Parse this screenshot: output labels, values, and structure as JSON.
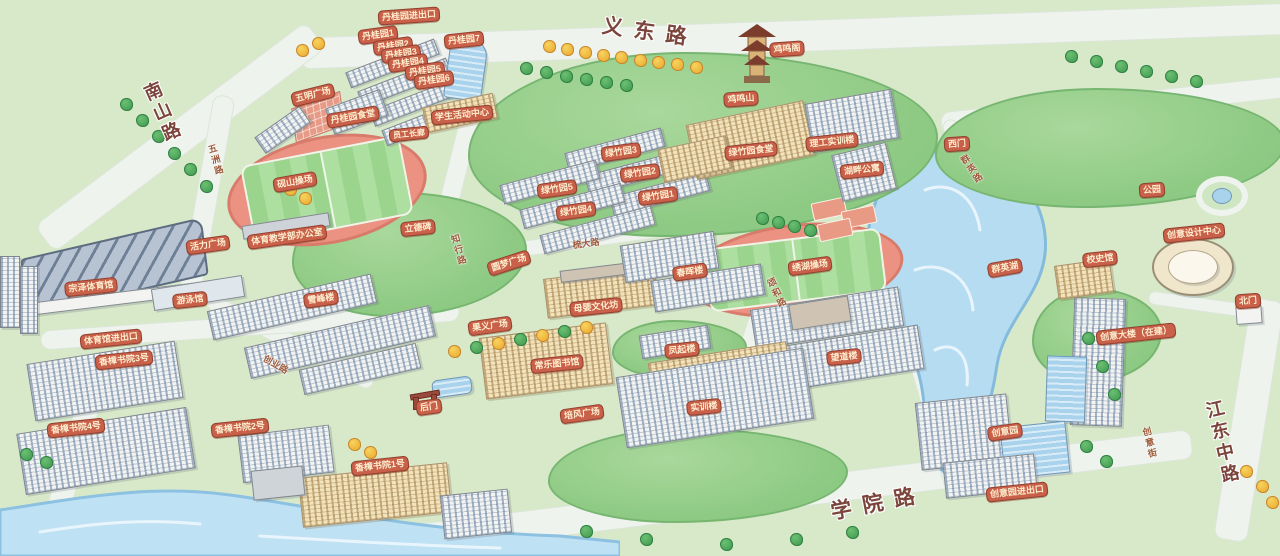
{
  "map": {
    "colors": {
      "ground_green": "#d8e9ca",
      "hill_green": "#8cc982",
      "road_light": "#eef3ee",
      "water_blue": "#b6dcf2",
      "track_salmon": "#ec9283",
      "field_green": "#9bd58d",
      "badge_bg": "#c96049",
      "badge_text": "#fdeecf",
      "major_road_text": "#7b453c"
    },
    "labels": [
      {
        "text": "丹桂园进出口",
        "x": 409,
        "y": 16,
        "rot": -4,
        "kind": "badge",
        "name": "label-gate-dangui"
      },
      {
        "text": "丹桂园1",
        "x": 378,
        "y": 35,
        "rot": -8,
        "kind": "badge",
        "name": "label-dorm-dangui-1"
      },
      {
        "text": "丹桂园2",
        "x": 393,
        "y": 46,
        "rot": -8,
        "kind": "badge",
        "name": "label-dorm-dangui-2"
      },
      {
        "text": "丹桂园3",
        "x": 401,
        "y": 54,
        "rot": -8,
        "kind": "badge",
        "name": "label-dorm-dangui-3"
      },
      {
        "text": "丹桂园4",
        "x": 408,
        "y": 63,
        "rot": -8,
        "kind": "badge",
        "name": "label-dorm-dangui-4"
      },
      {
        "text": "丹桂园5",
        "x": 425,
        "y": 71,
        "rot": -8,
        "kind": "badge",
        "name": "label-dorm-dangui-5"
      },
      {
        "text": "丹桂园6",
        "x": 434,
        "y": 80,
        "rot": -8,
        "kind": "badge",
        "name": "label-dorm-dangui-6"
      },
      {
        "text": "丹桂园7",
        "x": 464,
        "y": 40,
        "rot": -6,
        "kind": "badge",
        "name": "label-dorm-dangui-7"
      },
      {
        "text": "五明广场",
        "x": 313,
        "y": 95,
        "rot": -14,
        "kind": "badge",
        "name": "label-plaza-wuming"
      },
      {
        "text": "丹桂园食堂",
        "x": 353,
        "y": 117,
        "rot": -10,
        "kind": "badge",
        "name": "label-canteen-dangui"
      },
      {
        "text": "学生活动中心",
        "x": 462,
        "y": 115,
        "rot": -6,
        "kind": "badge",
        "name": "label-student-activity-center"
      },
      {
        "text": "员工长廊",
        "x": 409,
        "y": 134,
        "rot": -6,
        "kind": "badge-sm",
        "name": "label-staff-corridor"
      },
      {
        "text": "砚山操场",
        "x": 295,
        "y": 182,
        "rot": -10,
        "kind": "badge",
        "name": "label-stadium-yanshan"
      },
      {
        "text": "体育教学部办公室",
        "x": 287,
        "y": 237,
        "rot": -8,
        "kind": "badge",
        "name": "label-pe-office"
      },
      {
        "text": "立德碑",
        "x": 418,
        "y": 228,
        "rot": -6,
        "kind": "badge",
        "name": "label-monument-lide"
      },
      {
        "text": "活力广场",
        "x": 208,
        "y": 245,
        "rot": -8,
        "kind": "badge",
        "name": "label-plaza-vitality"
      },
      {
        "text": "宗泽体育馆",
        "x": 91,
        "y": 287,
        "rot": -6,
        "kind": "badge",
        "name": "label-gym-zongze"
      },
      {
        "text": "游泳馆",
        "x": 190,
        "y": 300,
        "rot": -6,
        "kind": "badge",
        "name": "label-natatorium"
      },
      {
        "text": "体育馆进出口",
        "x": 111,
        "y": 339,
        "rot": -6,
        "kind": "badge",
        "name": "label-gate-gym"
      },
      {
        "text": "香樟书院3号",
        "x": 124,
        "y": 360,
        "rot": -6,
        "kind": "badge",
        "name": "label-dorm-xiangzhang-3"
      },
      {
        "text": "香樟书院4号",
        "x": 76,
        "y": 428,
        "rot": -6,
        "kind": "badge",
        "name": "label-dorm-xiangzhang-4"
      },
      {
        "text": "香樟书院2号",
        "x": 240,
        "y": 428,
        "rot": -6,
        "kind": "badge",
        "name": "label-dorm-xiangzhang-2"
      },
      {
        "text": "香樟书院1号",
        "x": 380,
        "y": 466,
        "rot": -6,
        "kind": "badge",
        "name": "label-dorm-xiangzhang-1"
      },
      {
        "text": "雪峰楼",
        "x": 321,
        "y": 299,
        "rot": -8,
        "kind": "badge",
        "name": "label-building-xuefeng"
      },
      {
        "text": "后门",
        "x": 429,
        "y": 407,
        "rot": -8,
        "kind": "badge",
        "name": "label-back-gate"
      },
      {
        "text": "果义广场",
        "x": 490,
        "y": 326,
        "rot": -8,
        "kind": "badge",
        "name": "label-plaza-guoyi"
      },
      {
        "text": "常乐图书馆",
        "x": 557,
        "y": 364,
        "rot": -6,
        "kind": "badge",
        "name": "label-library-changle"
      },
      {
        "text": "母婴文化坊",
        "x": 596,
        "y": 307,
        "rot": -6,
        "kind": "badge",
        "name": "label-muying-culture-hall"
      },
      {
        "text": "圆梦广场",
        "x": 509,
        "y": 263,
        "rot": -18,
        "kind": "badge",
        "name": "label-plaza-yuanmeng"
      },
      {
        "text": "培风广场",
        "x": 582,
        "y": 414,
        "rot": -8,
        "kind": "badge",
        "name": "label-plaza-peifeng"
      },
      {
        "text": "实训楼",
        "x": 704,
        "y": 407,
        "rot": -6,
        "kind": "badge",
        "name": "label-training-building"
      },
      {
        "text": "凤起楼",
        "x": 682,
        "y": 350,
        "rot": -6,
        "kind": "badge",
        "name": "label-building-fengqi"
      },
      {
        "text": "望道楼",
        "x": 844,
        "y": 357,
        "rot": -6,
        "kind": "badge",
        "name": "label-building-wangdao"
      },
      {
        "text": "春晖楼",
        "x": 690,
        "y": 272,
        "rot": -8,
        "kind": "badge",
        "name": "label-building-chunhui"
      },
      {
        "text": "绣湖操场",
        "x": 810,
        "y": 266,
        "rot": -8,
        "kind": "badge",
        "name": "label-stadium-xiuhu"
      },
      {
        "text": "绿竹园3",
        "x": 621,
        "y": 152,
        "rot": -8,
        "kind": "badge",
        "name": "label-dorm-lvzhu-3"
      },
      {
        "text": "绿竹园2",
        "x": 640,
        "y": 173,
        "rot": -8,
        "kind": "badge",
        "name": "label-dorm-lvzhu-2"
      },
      {
        "text": "绿竹园5",
        "x": 557,
        "y": 189,
        "rot": -8,
        "kind": "badge",
        "name": "label-dorm-lvzhu-5"
      },
      {
        "text": "绿竹园1",
        "x": 658,
        "y": 196,
        "rot": -8,
        "kind": "badge",
        "name": "label-dorm-lvzhu-1"
      },
      {
        "text": "绿竹园4",
        "x": 576,
        "y": 211,
        "rot": -8,
        "kind": "badge",
        "name": "label-dorm-lvzhu-4"
      },
      {
        "text": "绿竹园食堂",
        "x": 751,
        "y": 151,
        "rot": -6,
        "kind": "badge",
        "name": "label-canteen-lvzhu"
      },
      {
        "text": "理工实训楼",
        "x": 832,
        "y": 142,
        "rot": -6,
        "kind": "badge",
        "name": "label-ligong-training"
      },
      {
        "text": "湖畔公寓",
        "x": 862,
        "y": 170,
        "rot": -6,
        "kind": "badge",
        "name": "label-apartment-hupan"
      },
      {
        "text": "西门",
        "x": 957,
        "y": 144,
        "rot": -4,
        "kind": "badge",
        "name": "label-west-gate"
      },
      {
        "text": "鸡鸣阁",
        "x": 787,
        "y": 49,
        "rot": -4,
        "kind": "badge",
        "name": "label-pavilion-jiming"
      },
      {
        "text": "鸡鸣山",
        "x": 741,
        "y": 99,
        "rot": -4,
        "kind": "badge",
        "name": "label-mountain-jiming"
      },
      {
        "text": "群英湖",
        "x": 1005,
        "y": 268,
        "rot": -10,
        "kind": "badge",
        "name": "label-lake-qunying"
      },
      {
        "text": "公园",
        "x": 1152,
        "y": 190,
        "rot": -4,
        "kind": "badge",
        "name": "label-park"
      },
      {
        "text": "创意设计中心",
        "x": 1194,
        "y": 233,
        "rot": -6,
        "kind": "badge",
        "name": "label-creative-design-center"
      },
      {
        "text": "校史馆",
        "x": 1100,
        "y": 259,
        "rot": -6,
        "kind": "badge",
        "name": "label-history-museum"
      },
      {
        "text": "北门",
        "x": 1248,
        "y": 301,
        "rot": -4,
        "kind": "badge",
        "name": "label-north-gate"
      },
      {
        "text": "创意大楼（在建）",
        "x": 1136,
        "y": 334,
        "rot": -6,
        "kind": "badge",
        "name": "label-creative-tower"
      },
      {
        "text": "创意园",
        "x": 1005,
        "y": 432,
        "rot": -8,
        "kind": "badge",
        "name": "label-creative-park"
      },
      {
        "text": "创意园进出口",
        "x": 1017,
        "y": 492,
        "rot": -6,
        "kind": "badge",
        "name": "label-gate-creative-park"
      },
      {
        "text": "五洲路",
        "x": 216,
        "y": 160,
        "rot": -16,
        "kind": "road-sub-v",
        "name": "label-road-wuzhou"
      },
      {
        "text": "知行路",
        "x": 459,
        "y": 250,
        "rot": -16,
        "kind": "road-sub-v",
        "name": "label-road-zhixing"
      },
      {
        "text": "创业路",
        "x": 276,
        "y": 364,
        "rot": 30,
        "kind": "road-sub",
        "name": "label-road-chuangye"
      },
      {
        "text": "梳大路",
        "x": 586,
        "y": 243,
        "rot": -8,
        "kind": "road-sub",
        "name": "label-road-shuda"
      },
      {
        "text": "颂和路",
        "x": 777,
        "y": 293,
        "rot": -26,
        "kind": "road-sub-v",
        "name": "label-road-songhe"
      },
      {
        "text": "群英路",
        "x": 972,
        "y": 169,
        "rot": -34,
        "kind": "road-sub-v",
        "name": "label-road-qunying"
      },
      {
        "text": "创意街",
        "x": 1150,
        "y": 443,
        "rot": -14,
        "kind": "road-sub-v",
        "name": "label-street-chuangyi"
      },
      {
        "text": "南山路",
        "x": 162,
        "y": 113,
        "rot": -24,
        "kind": "road-major-v",
        "name": "label-road-nanshan"
      },
      {
        "text": "义东路",
        "x": 650,
        "y": 31,
        "rot": 8,
        "kind": "road-major",
        "name": "label-road-yidong"
      },
      {
        "text": "学院路",
        "x": 878,
        "y": 502,
        "rot": -11,
        "kind": "road-major",
        "name": "label-road-xueyuan"
      },
      {
        "text": "江东中路",
        "x": 1222,
        "y": 443,
        "rot": -13,
        "kind": "road-major-v",
        "name": "label-road-jiangdong"
      }
    ]
  }
}
